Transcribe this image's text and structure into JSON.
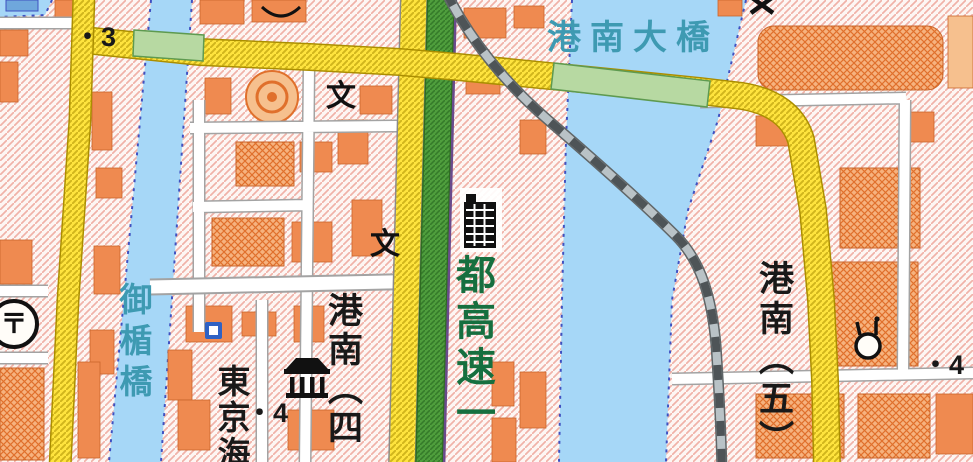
{
  "map": {
    "colors": {
      "bg": "#fdf6f3",
      "water": "#a6d7f7",
      "hatch_pink": "#f0b2a8",
      "building": "#ef8a50",
      "building_light": "#f6c08e",
      "building_line": "#c9652b",
      "road_yellow": "#ffe43e",
      "road_casing": "#ab8e00",
      "green_strip": "#4f9e3d",
      "bridge_green": "#b7d9a2",
      "monorail": "#b9c2c6",
      "text_teal": "#3e9ab2",
      "text_green": "#166f3f",
      "boundary_navy": "#3f51c1",
      "boundary_purple": "#6a4a8c"
    },
    "labels": {
      "bridge_main": "港南大橋",
      "bridge_left": "御楯橋",
      "expressway": "都高速一",
      "district_sw": "港南（四",
      "district_e": "港南（五）",
      "partial_sw": "東京海",
      "elev_nw": "・3",
      "elev_sw": "・4",
      "elev_e": "・4"
    },
    "icons": {
      "school_1": "文",
      "school_2": "文",
      "post_office": "〒"
    }
  }
}
